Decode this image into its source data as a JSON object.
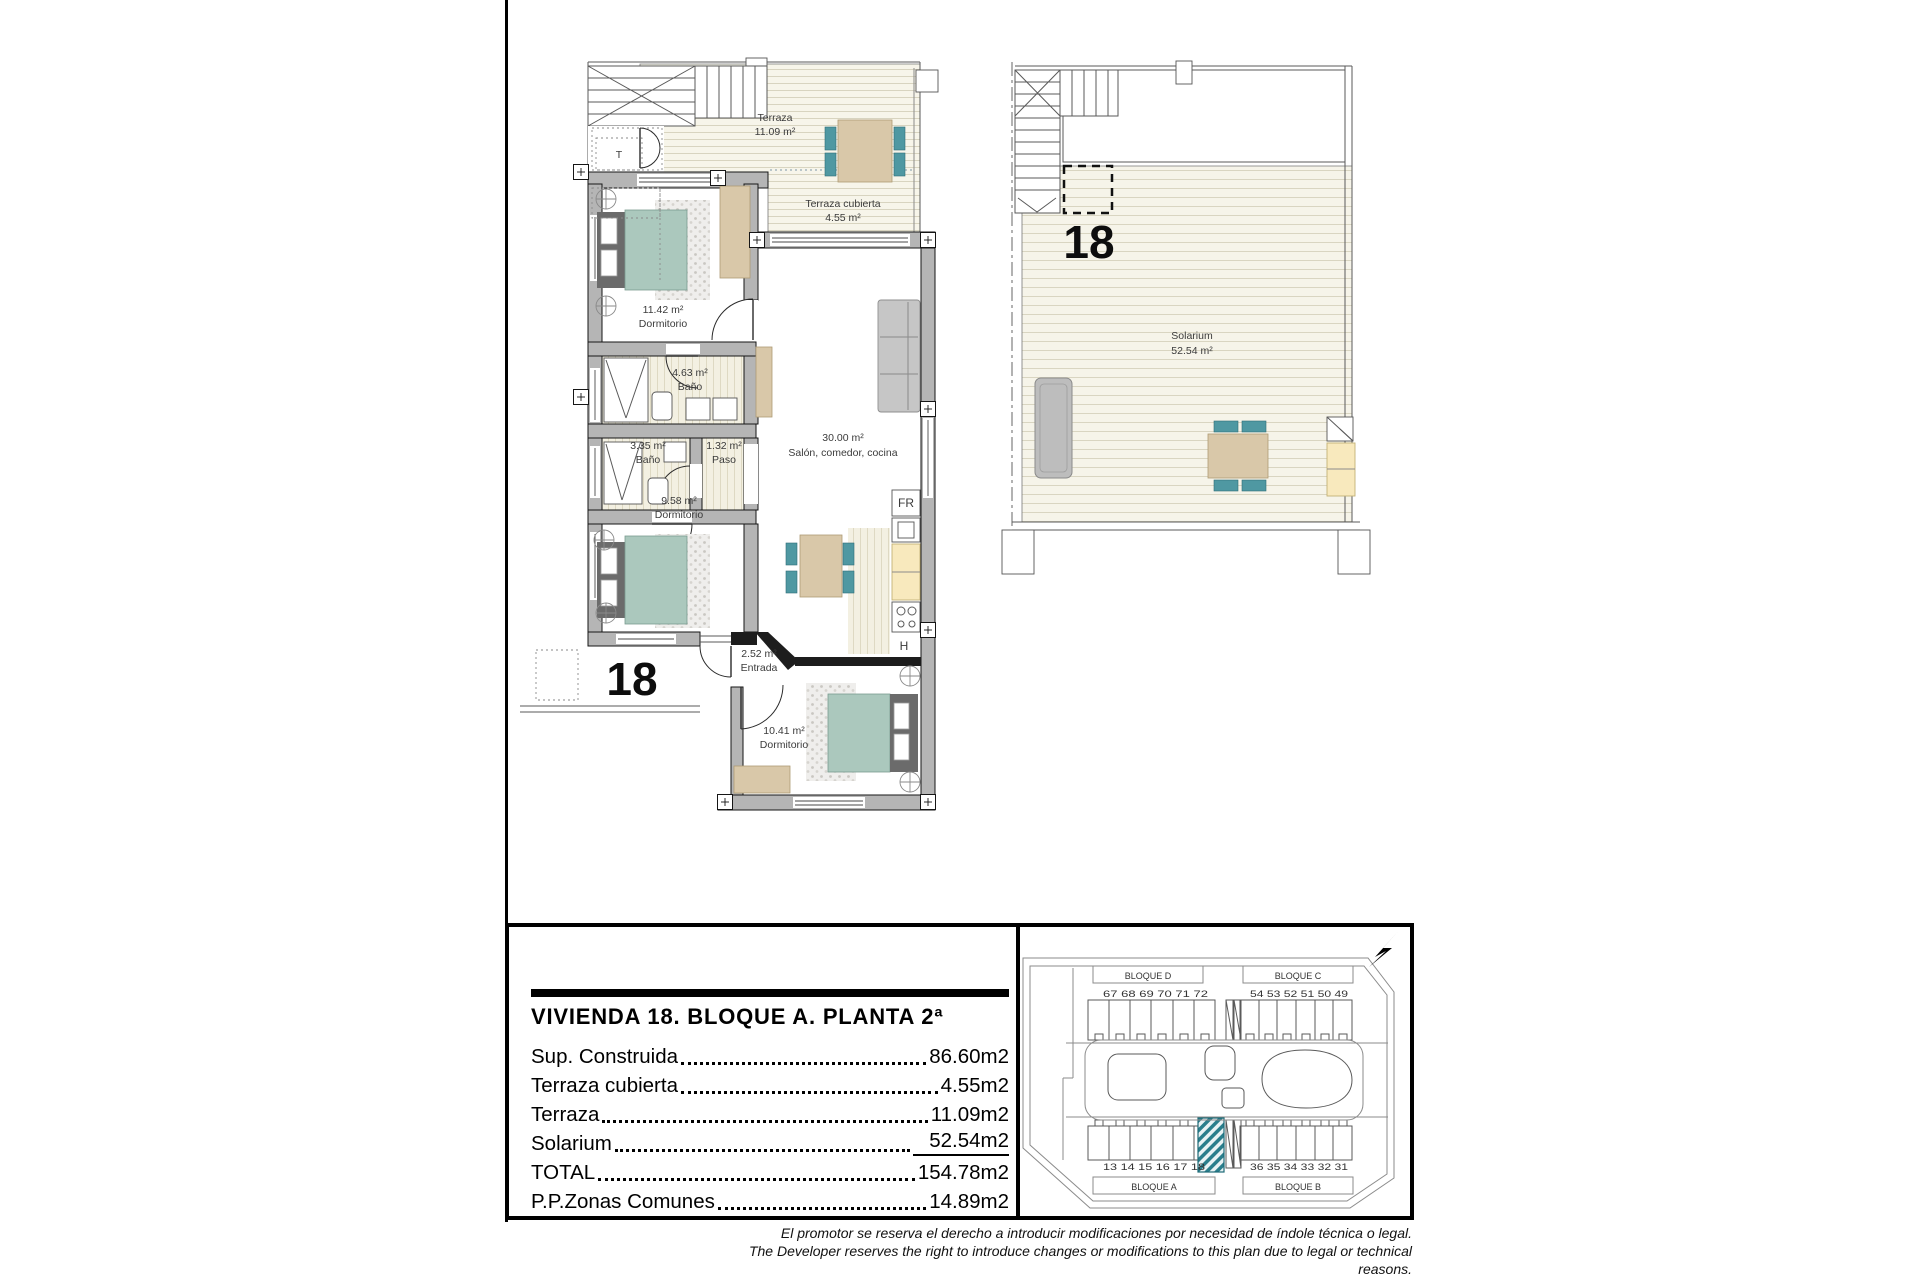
{
  "plan_apartment": {
    "unit_number": "18",
    "terraza": {
      "name": "Terraza",
      "area": "11.09 m²"
    },
    "terraza_cubierta": {
      "name": "Terraza cubierta",
      "area": "4.55 m²"
    },
    "dormitorio1": {
      "area": "11.42 m²",
      "name": "Dormitorio"
    },
    "bano1": {
      "area": "4.63 m²",
      "name": "Baño"
    },
    "bano2": {
      "area": "3.35 m²",
      "name": "Baño"
    },
    "paso": {
      "area": "1.32 m²",
      "name": "Paso"
    },
    "salon": {
      "area": "30.00 m²",
      "name": "Salón, comedor, cocina"
    },
    "dormitorio2": {
      "area": "9.58 m²",
      "name": "Dormitorio"
    },
    "entrada": {
      "area": "2.52 m²",
      "name": "Entrada"
    },
    "dormitorio3": {
      "area": "10.41 m²",
      "name": "Dormitorio"
    },
    "t_label": "T",
    "fridge_label": "FR",
    "hob_label": "H"
  },
  "plan_solarium": {
    "unit_number": "18",
    "solarium": {
      "name": "Solarium",
      "area": "52.54 m²"
    }
  },
  "info_panel": {
    "title": "VIVIENDA 18. BLOQUE A. PLANTA 2ª",
    "rows": [
      {
        "label": "Sup. Construida",
        "value": "86.60m2"
      },
      {
        "label": "Terraza cubierta",
        "value": "4.55m2"
      },
      {
        "label": "Terraza",
        "value": "11.09m2"
      },
      {
        "label": "Solarium",
        "value": "52.54m2"
      },
      {
        "label": "TOTAL",
        "value": "154.78m2"
      },
      {
        "label": "P.P.Zonas Comunes",
        "value": "14.89m2"
      }
    ]
  },
  "site_plan": {
    "blocks": {
      "d": "BLOQUE D",
      "c": "BLOQUE C",
      "a": "BLOQUE A",
      "b": "BLOQUE B"
    },
    "units_top_left": "67 68 69 70 71 72",
    "units_top_right": "54 53 52 51 50 49",
    "units_bottom_left": "13 14 15 16 17 18",
    "units_bottom_right": "36 35 34 33 32 31",
    "highlight_color": "#2a7e8c"
  },
  "disclaimer": {
    "line1": "El promotor se reserva el derecho a introducir modificaciones por necesidad de índole técnica o legal.",
    "line2": "The Developer reserves the right to introduce changes or modifications to this plan due to legal or technical reasons."
  },
  "colors": {
    "wall_gray": "#b5b5b5",
    "deck_cream": "#f7f5ea",
    "bed_green": "#abc8bd",
    "furniture_tan": "#d9c8a9",
    "chair_teal": "#4f98a2",
    "counter_yellow": "#f8e9bd",
    "unit_highlight": "#2a7e8c"
  }
}
